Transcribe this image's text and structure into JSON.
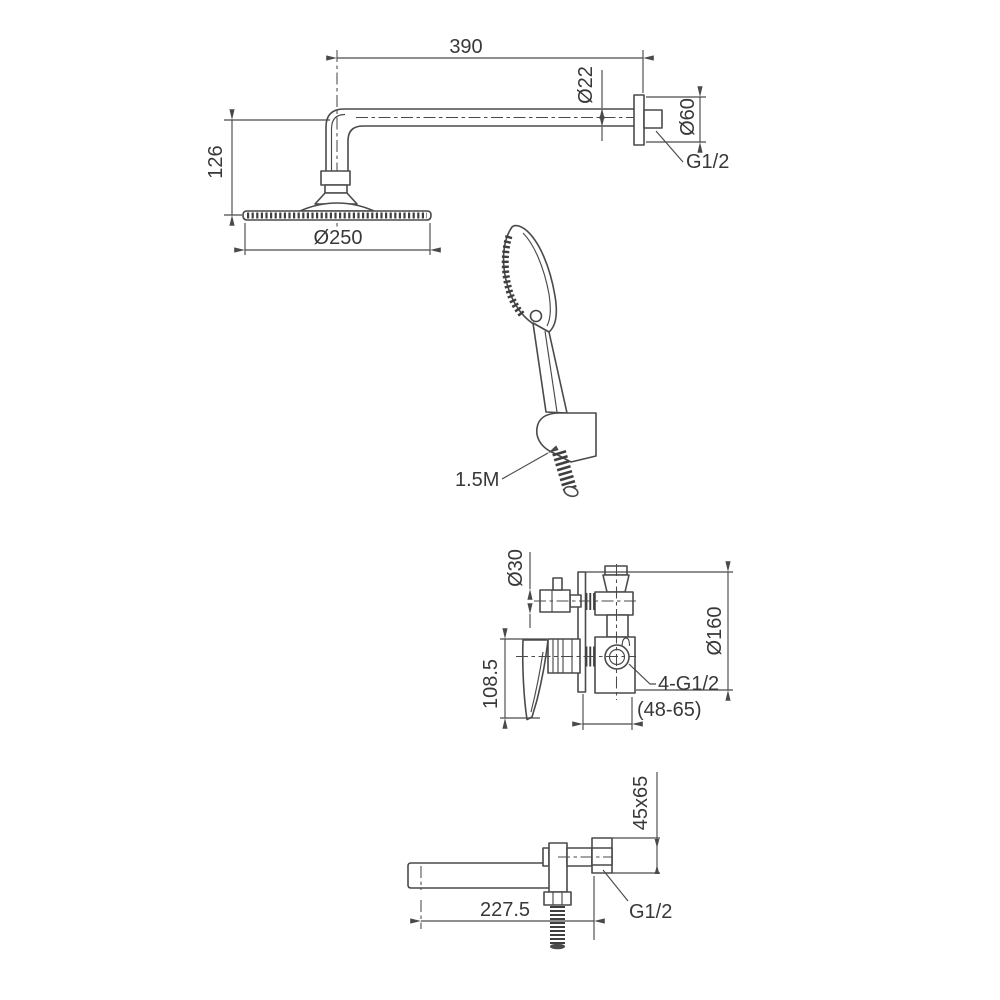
{
  "colors": {
    "background": "#ffffff",
    "line": "#4a4a4a",
    "text": "#383838"
  },
  "drawing": {
    "overhead_shower": {
      "arm_length": "390",
      "arm_diameter": "Ø22",
      "escutcheon_diameter": "Ø60",
      "wall_thread": "G1/2",
      "head_drop": "126",
      "head_diameter": "Ø250"
    },
    "hand_shower": {
      "hose_length": "1.5M"
    },
    "mixer_valve": {
      "diverter_diameter": "Ø30",
      "plate_diameter": "Ø160",
      "handle_length": "108.5",
      "connection_threads": "4-G1/2",
      "embed_depth": "(48-65)"
    },
    "spout": {
      "bracket_section": "45x65",
      "reach": "227.5",
      "wall_thread": "G1/2"
    }
  }
}
